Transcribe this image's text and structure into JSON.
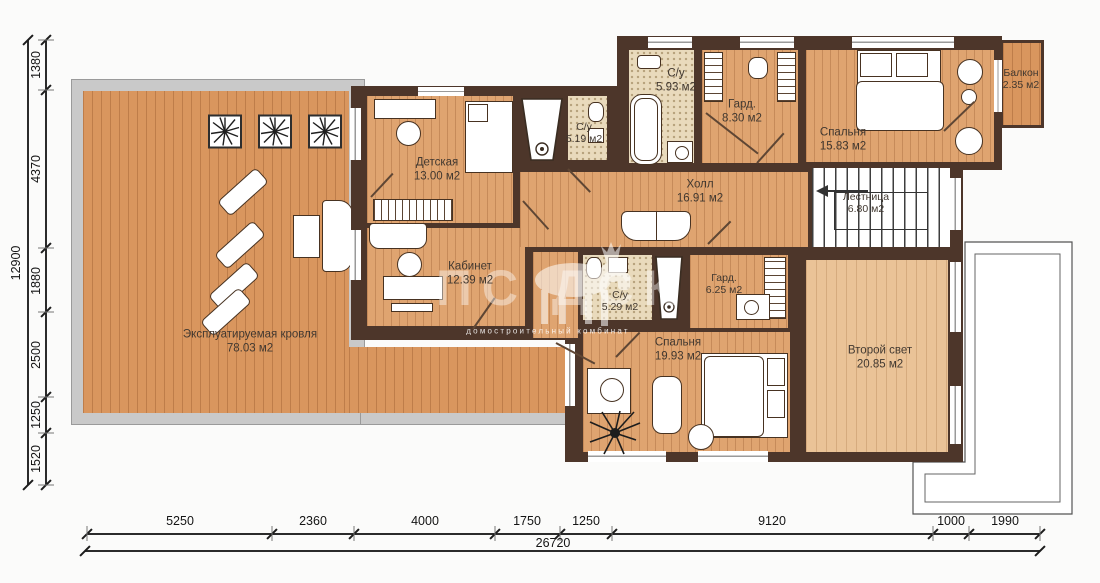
{
  "rooms": {
    "terrace": {
      "name": "Эксплуатируемая кровля",
      "area": "78.03 м2"
    },
    "detskaya": {
      "name": "Детская",
      "area": "13.00 м2"
    },
    "su_519": {
      "name": "С/у",
      "area": "5.19 м2"
    },
    "su_593": {
      "name": "С/у",
      "area": "5.93 м2"
    },
    "gard_830": {
      "name": "Гард.",
      "area": "8.30 м2"
    },
    "bedroom_1583": {
      "name": "Спальня",
      "area": "15.83 м2"
    },
    "balcony": {
      "name": "Балкон",
      "area": "2.35 м2"
    },
    "hall": {
      "name": "Холл",
      "area": "16.91 м2"
    },
    "stairs": {
      "name": "Лестница",
      "area": "6.80 м2"
    },
    "kabinet": {
      "name": "Кабинет",
      "area": "12.39 м2"
    },
    "su_529": {
      "name": "С/у",
      "area": "5.29 м2"
    },
    "gard_625": {
      "name": "Гард.",
      "area": "6.25 м2"
    },
    "bedroom_1993": {
      "name": "Спальня",
      "area": "19.93 м2"
    },
    "second_light": {
      "name": "Второй свет",
      "area": "20.85 м2"
    }
  },
  "dims": {
    "left_total": "12900",
    "left": [
      "1380",
      "4370",
      "1880",
      "2500",
      "1250",
      "1520"
    ],
    "bottom": [
      "5250",
      "2360",
      "4000",
      "1750",
      "1250",
      "9120",
      "1000",
      "1990"
    ],
    "bottom_total": "26720"
  },
  "watermark": {
    "logo": "ПС ДСК",
    "caption": "домостроительный комбинат"
  },
  "colors": {
    "wall": "#4d362a",
    "wood": "#dfa470",
    "wood_terrace": "#d9965e",
    "wood_light": "#eac397",
    "tile": "#e9dabc",
    "parapet": "#c9c9c9"
  }
}
